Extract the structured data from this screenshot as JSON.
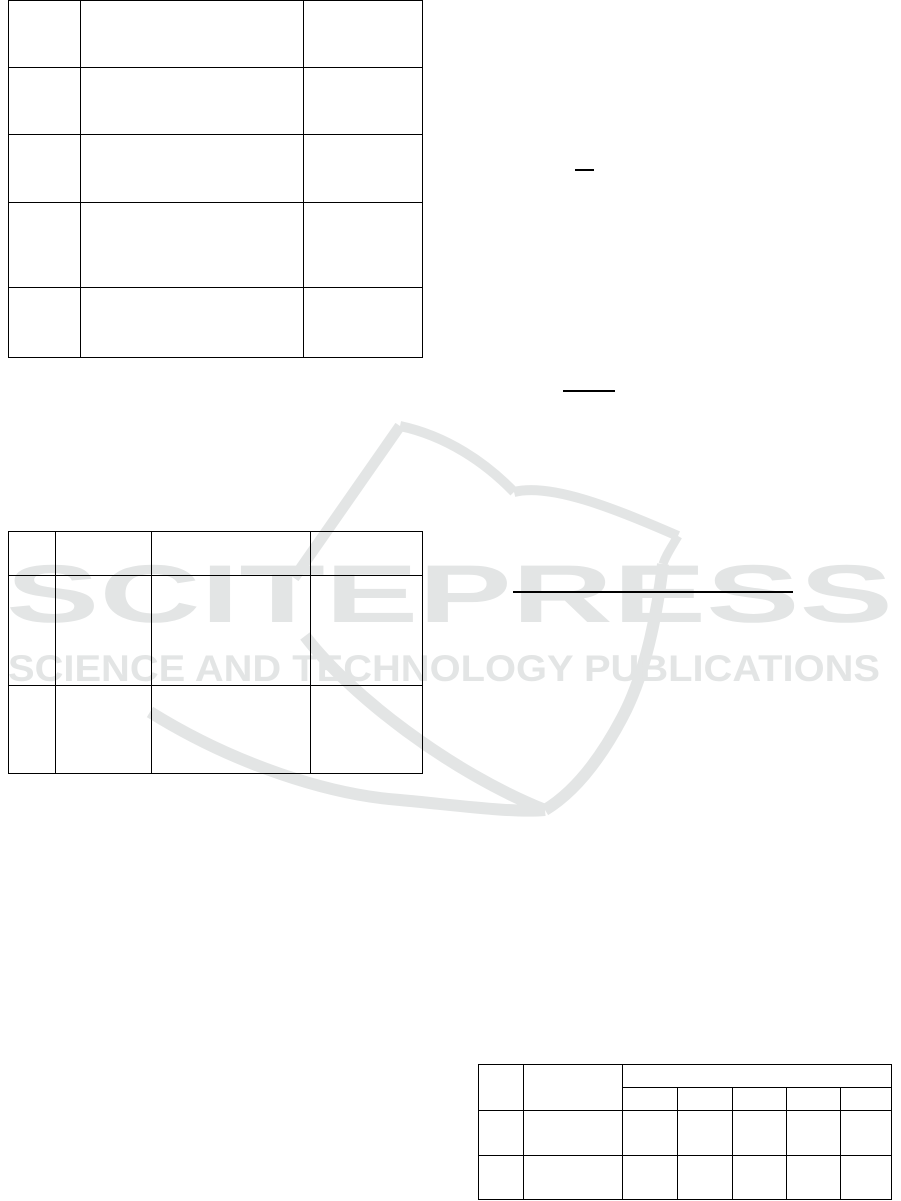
{
  "watermark": {
    "title": "SCITEPRESS",
    "subtitle": "SCIENCE AND TECHNOLOGY PUBLICATIONS",
    "color": "#e3e5e5",
    "logo": "open-book-with-pennant"
  },
  "tables": {
    "top_left": {
      "columns": 3,
      "rows": 5,
      "all_cells_empty": true
    },
    "middle_left": {
      "columns": 4,
      "rows": 3,
      "all_cells_empty": true
    },
    "bottom_right": {
      "columns": 7,
      "body_rows": 2,
      "header": {
        "left_rowspan_cells": 2,
        "grouped_span_columns": 5,
        "sub_header_cells": 5
      },
      "all_cells_empty": true
    }
  },
  "rules": {
    "count": 3,
    "description": "short black horizontal rules (unrendered equation fraction bars / underlines)"
  }
}
